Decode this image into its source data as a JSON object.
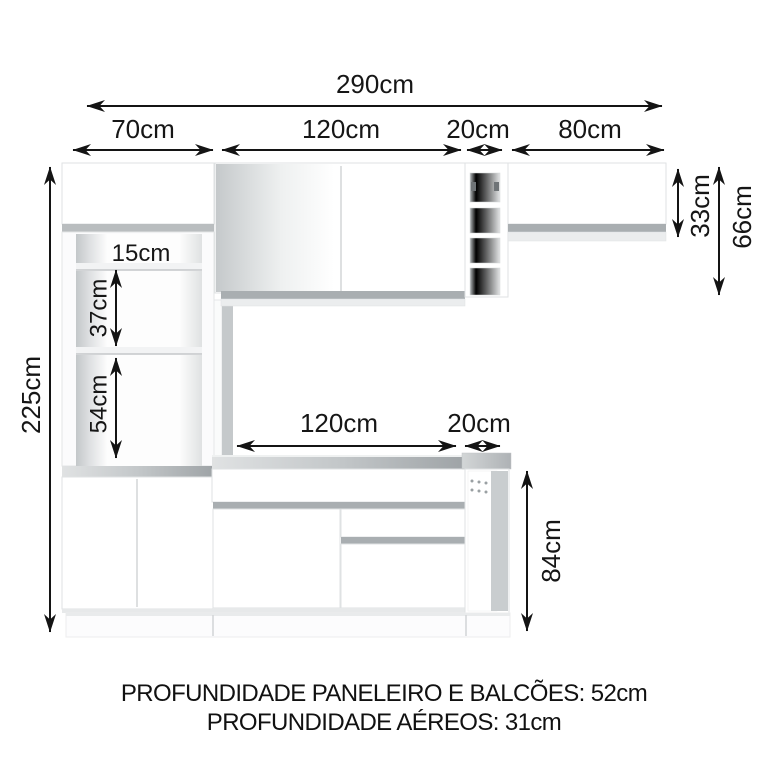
{
  "diagram": {
    "dims": {
      "total_width": "290cm",
      "col_paneleiro": "70cm",
      "col_aereo": "120cm",
      "col_nicho": "20cm",
      "col_aereo2": "80cm",
      "height_total": "225cm",
      "niche_gap_1": "15cm",
      "niche_gap_2": "37cm",
      "niche_gap_3": "54cm",
      "base_width": "120cm",
      "base_nicho_width": "20cm",
      "base_height": "84cm",
      "aereo2_height": "33cm",
      "aereo_stack_height": "66cm"
    },
    "footer": {
      "line1": "PROFUNDIDADE PANELEIRO E BALCÕES: 52cm",
      "line2": "PROFUNDIDADE AÉREOS: 31cm"
    }
  }
}
